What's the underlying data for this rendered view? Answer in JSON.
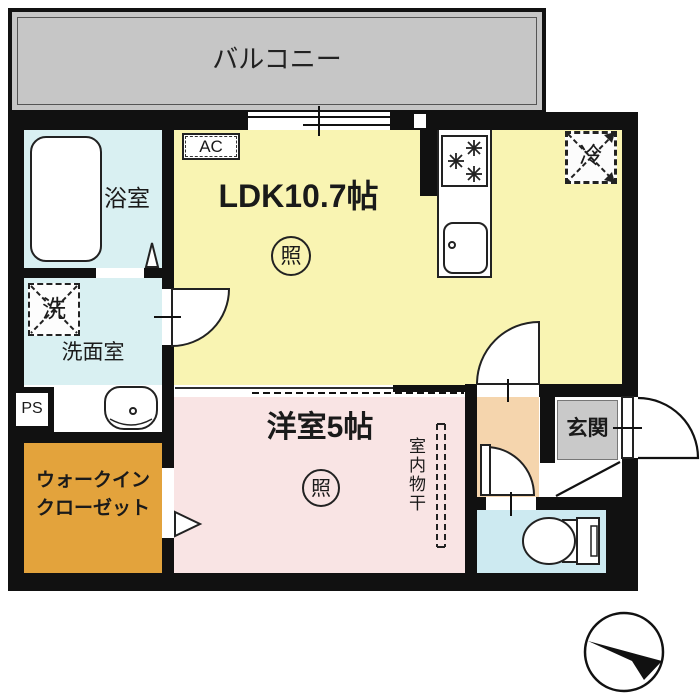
{
  "floorplan": {
    "balcony": {
      "label": "バルコニー"
    },
    "ldk": {
      "label": "LDK10.7帖",
      "ac_label": "AC",
      "light_symbol": "照",
      "fridge_symbol": "冷"
    },
    "bathroom": {
      "label": "浴室"
    },
    "washroom": {
      "label": "洗面室",
      "washer_symbol": "洗",
      "ps_label": "PS"
    },
    "wic": {
      "label_line1": "ウォークイン",
      "label_line2": "クローゼット"
    },
    "western_room": {
      "label": "洋室5帖",
      "light_symbol": "照",
      "indoor_drying_label": "室内物干"
    },
    "genkan": {
      "label": "玄関"
    },
    "colors": {
      "wall": "#111111",
      "balcony": "#c6c6c6",
      "ldk": "#f9f4b2",
      "bathroom": "#d9f0f2",
      "washroom": "#d9f0f2",
      "toilet": "#cdeaf1",
      "wic": "#e3a33c",
      "western_room": "#f9e4e4",
      "hallway": "#f5d5ad",
      "genkan_tile": "#c9c9c9"
    }
  }
}
